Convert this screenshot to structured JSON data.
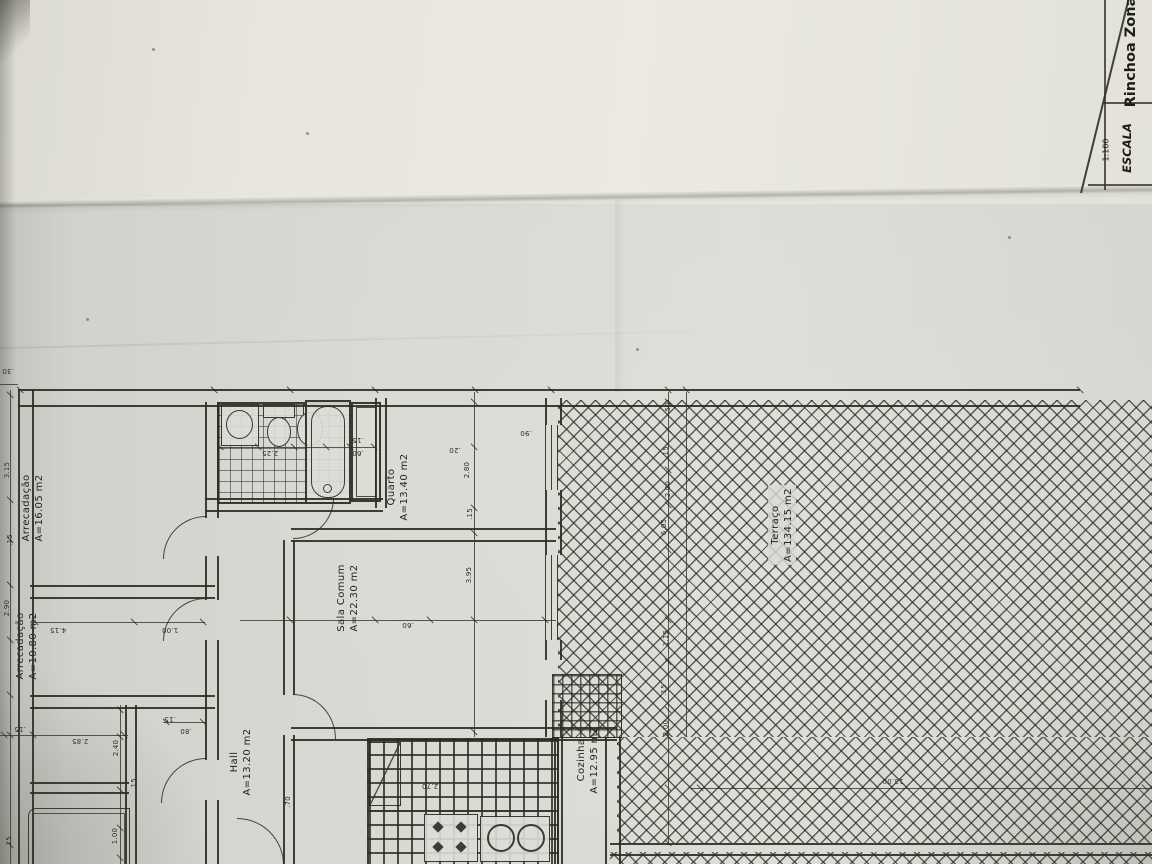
{
  "title_block": {
    "scale_label": "ESCALA",
    "scale_value": "1:100",
    "zone_name": "Rinchoa Zona"
  },
  "rooms": [
    {
      "name": "Arrecadação",
      "area": "A=16.05 m2"
    },
    {
      "name": "Arrecadação",
      "area": "A=10.80 m2"
    },
    {
      "name": "Hall",
      "area": "A=13.20 m2"
    },
    {
      "name": "Quarto",
      "area": "A=13.40 m2"
    },
    {
      "name": "Sala Comum",
      "area": "A=22.30 m2"
    },
    {
      "name": "Cozinha",
      "area": "A=12.95 m2"
    },
    {
      "name": "Terraço",
      "area": "A=134.15 m2"
    }
  ],
  "dims": [
    ".30",
    ".20",
    "2.80",
    ".15",
    "3.95",
    ".90",
    ".15",
    ".60",
    "2.25",
    "3.15",
    ".15",
    "2.90",
    "4.15",
    "1.00",
    ".15",
    ".80",
    "2.85",
    ".15",
    "2.40",
    ".15",
    "1.00",
    ".15",
    ".70",
    "2.70",
    "13.00",
    ".50",
    ".15",
    "2.00",
    "6.05",
    "1.15",
    ".15",
    "2.00",
    ".60"
  ]
}
